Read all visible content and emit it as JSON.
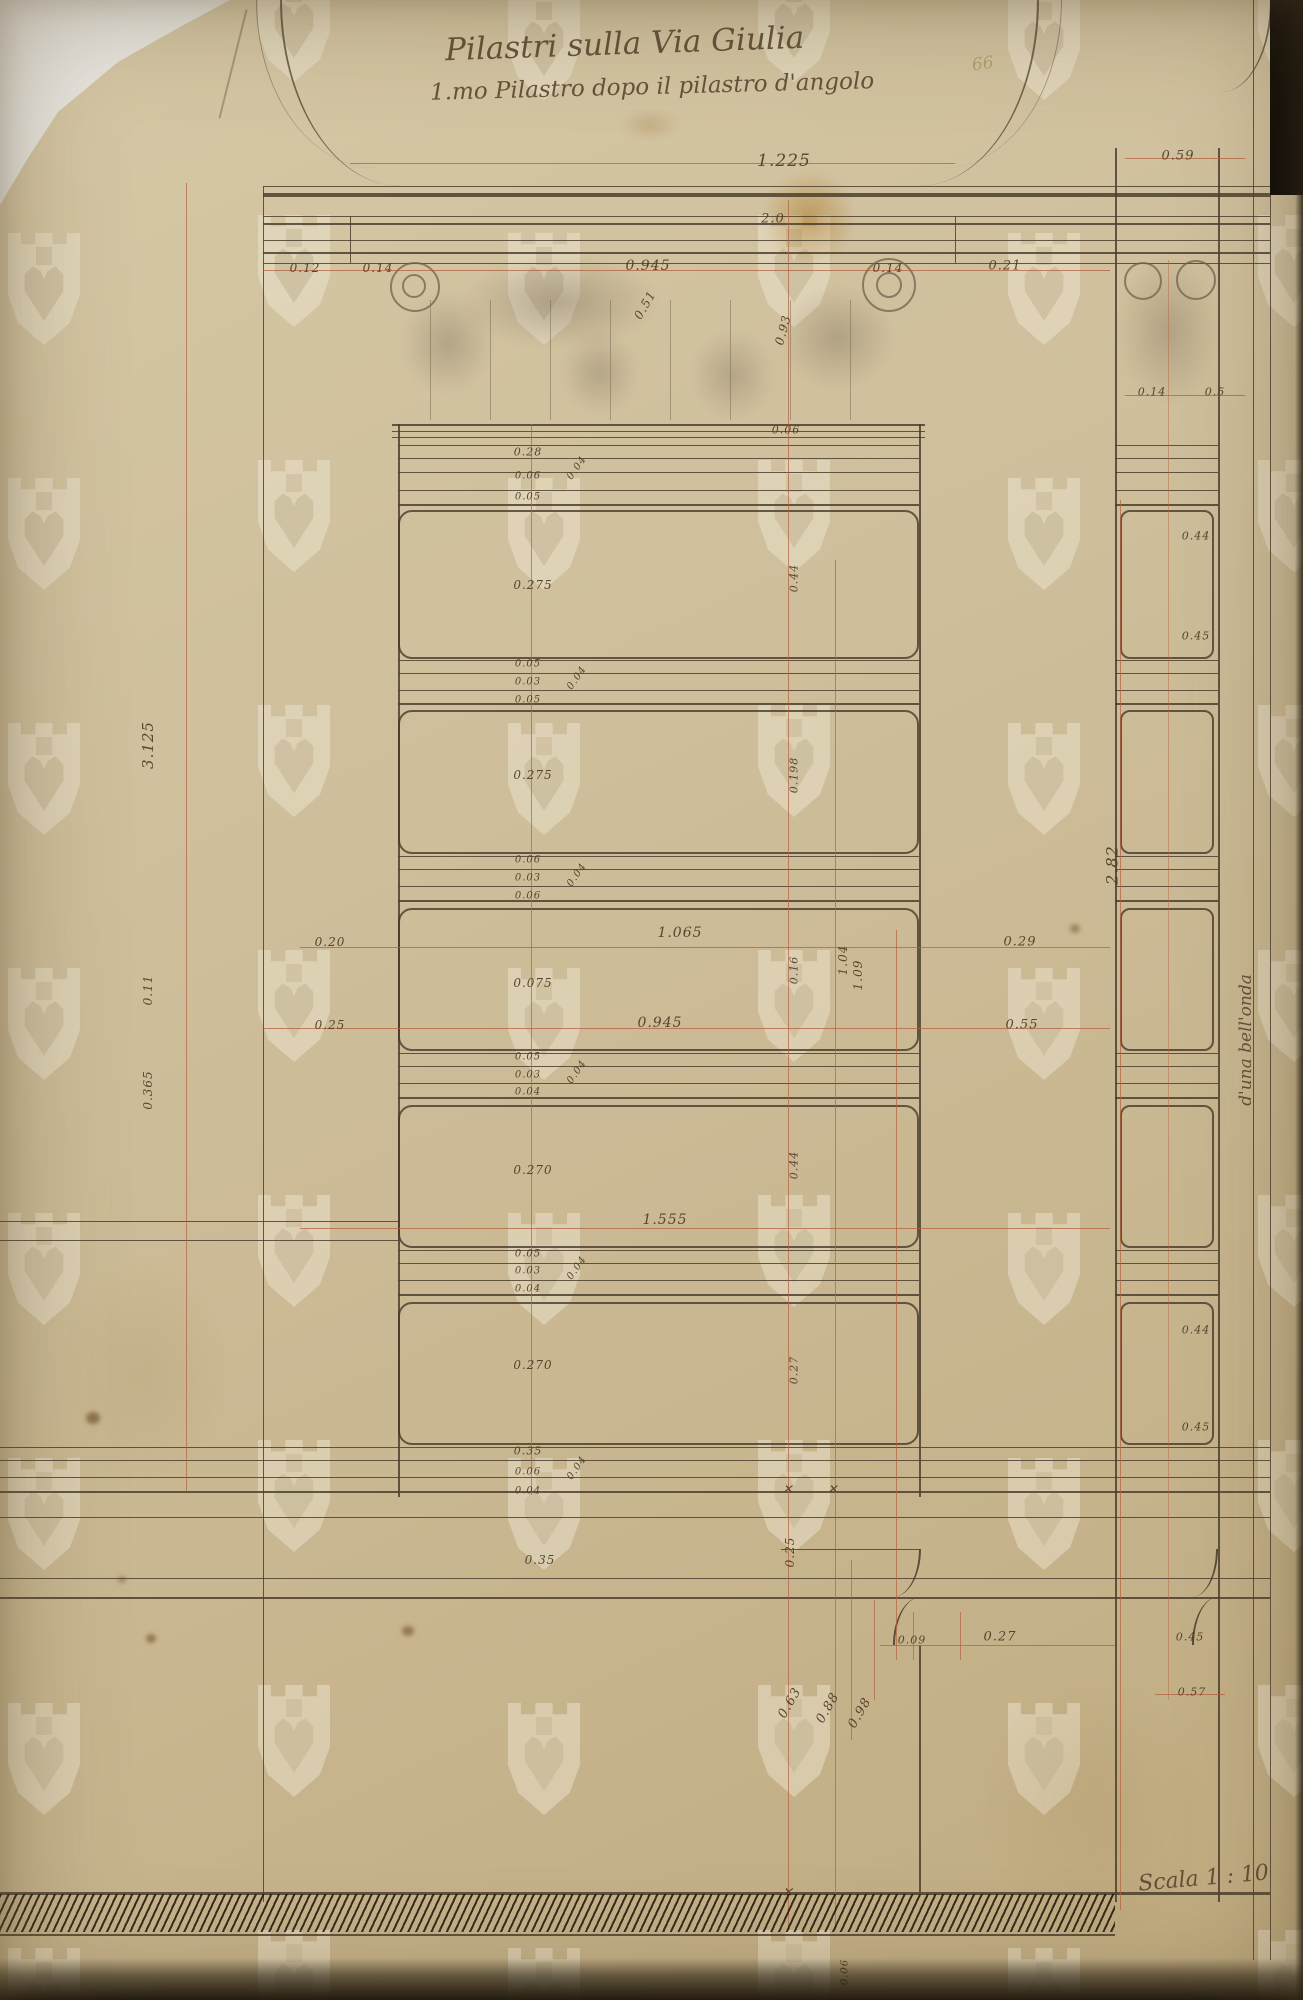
{
  "document": {
    "title_line1": "Pilastri sulla Via Giulia",
    "title_line2": "1.mo Pilastro dopo il pilastro d'angolo",
    "scale_label": "Scala 1 : 10",
    "side_note": "d'una bell'onda",
    "pencil_note": "66"
  },
  "colors": {
    "paper": "#cfbf9c",
    "sepia_ink": "#4c3f2f",
    "red_ink": "#b4623e",
    "pencil": "#776752",
    "backdrop": "#e9e7e1"
  },
  "dimension_labels": [
    {
      "text": "1.225",
      "x": 784,
      "y": 161,
      "size": 17
    },
    {
      "text": "0.59",
      "x": 1178,
      "y": 156,
      "size": 13
    },
    {
      "text": "2.0",
      "x": 773,
      "y": 219,
      "size": 13
    },
    {
      "text": "0.12",
      "x": 305,
      "y": 268,
      "size": 12
    },
    {
      "text": "0.14",
      "x": 378,
      "y": 268,
      "size": 12
    },
    {
      "text": "0.945",
      "x": 648,
      "y": 266,
      "size": 14
    },
    {
      "text": "0.14",
      "x": 888,
      "y": 268,
      "size": 12
    },
    {
      "text": "0.21",
      "x": 1005,
      "y": 266,
      "size": 13
    },
    {
      "text": "0.51",
      "x": 645,
      "y": 305,
      "rot": -60,
      "size": 12
    },
    {
      "text": "0.93",
      "x": 783,
      "y": 330,
      "rot": -75,
      "size": 12
    },
    {
      "text": "0.06",
      "x": 786,
      "y": 430,
      "size": 11
    },
    {
      "text": "0.28",
      "x": 528,
      "y": 452,
      "size": 11
    },
    {
      "text": "0.06",
      "x": 528,
      "y": 476,
      "size": 10
    },
    {
      "text": "0.05",
      "x": 528,
      "y": 497,
      "size": 10
    },
    {
      "text": "0.04",
      "x": 577,
      "y": 468,
      "rot": -55,
      "size": 10
    },
    {
      "text": "0.275",
      "x": 533,
      "y": 585,
      "size": 12
    },
    {
      "text": "0.05",
      "x": 528,
      "y": 664,
      "size": 10
    },
    {
      "text": "0.03",
      "x": 528,
      "y": 682,
      "size": 10
    },
    {
      "text": "0.05",
      "x": 528,
      "y": 700,
      "size": 10
    },
    {
      "text": "0.04",
      "x": 577,
      "y": 678,
      "rot": -55,
      "size": 10
    },
    {
      "text": "0.275",
      "x": 533,
      "y": 775,
      "size": 12
    },
    {
      "text": "0.06",
      "x": 528,
      "y": 860,
      "size": 10
    },
    {
      "text": "0.03",
      "x": 528,
      "y": 878,
      "size": 10
    },
    {
      "text": "0.06",
      "x": 528,
      "y": 896,
      "size": 10
    },
    {
      "text": "0.04",
      "x": 577,
      "y": 875,
      "rot": -55,
      "size": 10
    },
    {
      "text": "0.075",
      "x": 533,
      "y": 983,
      "size": 12
    },
    {
      "text": "0.05",
      "x": 528,
      "y": 1057,
      "size": 10
    },
    {
      "text": "0.03",
      "x": 528,
      "y": 1075,
      "size": 10
    },
    {
      "text": "0.04",
      "x": 528,
      "y": 1092,
      "size": 10
    },
    {
      "text": "0.04",
      "x": 577,
      "y": 1072,
      "rot": -55,
      "size": 10
    },
    {
      "text": "0.270",
      "x": 533,
      "y": 1170,
      "size": 12
    },
    {
      "text": "0.05",
      "x": 528,
      "y": 1254,
      "size": 10
    },
    {
      "text": "0.03",
      "x": 528,
      "y": 1271,
      "size": 10
    },
    {
      "text": "0.04",
      "x": 528,
      "y": 1289,
      "size": 10
    },
    {
      "text": "0.04",
      "x": 577,
      "y": 1268,
      "rot": -55,
      "size": 10
    },
    {
      "text": "0.270",
      "x": 533,
      "y": 1365,
      "size": 12
    },
    {
      "text": "0.35",
      "x": 528,
      "y": 1451,
      "size": 11
    },
    {
      "text": "0.06",
      "x": 528,
      "y": 1472,
      "size": 10
    },
    {
      "text": "0.04",
      "x": 528,
      "y": 1491,
      "size": 10
    },
    {
      "text": "0.04",
      "x": 577,
      "y": 1468,
      "rot": -55,
      "size": 10
    },
    {
      "text": "0.44",
      "x": 794,
      "y": 578,
      "rot": -90,
      "size": 11
    },
    {
      "text": "0.198",
      "x": 794,
      "y": 775,
      "rot": -90,
      "size": 11
    },
    {
      "text": "0.16",
      "x": 794,
      "y": 970,
      "rot": -90,
      "size": 11
    },
    {
      "text": "0.44",
      "x": 794,
      "y": 1165,
      "rot": -90,
      "size": 11
    },
    {
      "text": "0.27",
      "x": 794,
      "y": 1370,
      "rot": -90,
      "size": 11
    },
    {
      "text": "1.04",
      "x": 843,
      "y": 960,
      "rot": -90,
      "size": 12
    },
    {
      "text": "1.09",
      "x": 858,
      "y": 975,
      "rot": -90,
      "size": 12
    },
    {
      "text": "0.20",
      "x": 330,
      "y": 942,
      "size": 12
    },
    {
      "text": "1.065",
      "x": 680,
      "y": 933,
      "size": 14
    },
    {
      "text": "0.29",
      "x": 1020,
      "y": 942,
      "size": 13
    },
    {
      "text": "0.25",
      "x": 330,
      "y": 1025,
      "size": 12
    },
    {
      "text": "0.945",
      "x": 660,
      "y": 1023,
      "size": 14
    },
    {
      "text": "0.55",
      "x": 1022,
      "y": 1025,
      "size": 13
    },
    {
      "text": "1.555",
      "x": 665,
      "y": 1220,
      "size": 14
    },
    {
      "text": "3.125",
      "x": 148,
      "y": 745,
      "rot": -90,
      "size": 15
    },
    {
      "text": "0.11",
      "x": 148,
      "y": 990,
      "rot": -90,
      "size": 12
    },
    {
      "text": "0.365",
      "x": 148,
      "y": 1090,
      "rot": -90,
      "size": 12
    },
    {
      "text": "2.82",
      "x": 1112,
      "y": 865,
      "rot": -90,
      "size": 16
    },
    {
      "text": "0.14",
      "x": 1152,
      "y": 392,
      "size": 11
    },
    {
      "text": "0.5",
      "x": 1215,
      "y": 392,
      "size": 11
    },
    {
      "text": "0.44",
      "x": 1196,
      "y": 536,
      "size": 11
    },
    {
      "text": "0.45",
      "x": 1196,
      "y": 636,
      "size": 11
    },
    {
      "text": "0.44",
      "x": 1196,
      "y": 1330,
      "size": 11
    },
    {
      "text": "0.45",
      "x": 1196,
      "y": 1427,
      "size": 11
    },
    {
      "text": "0.45",
      "x": 1190,
      "y": 1637,
      "size": 11
    },
    {
      "text": "0.57",
      "x": 1192,
      "y": 1692,
      "size": 11
    },
    {
      "text": "0.25",
      "x": 790,
      "y": 1552,
      "rot": -90,
      "size": 12
    },
    {
      "text": "0.35",
      "x": 540,
      "y": 1560,
      "size": 12
    },
    {
      "text": "0.09",
      "x": 912,
      "y": 1640,
      "size": 11
    },
    {
      "text": "0.27",
      "x": 1000,
      "y": 1637,
      "size": 13
    },
    {
      "text": "0.63",
      "x": 790,
      "y": 1703,
      "rot": -60,
      "size": 13
    },
    {
      "text": "0.88",
      "x": 828,
      "y": 1708,
      "rot": -60,
      "size": 13
    },
    {
      "text": "0.98",
      "x": 860,
      "y": 1713,
      "rot": -60,
      "size": 13
    },
    {
      "text": "0.06",
      "x": 845,
      "y": 1972,
      "rot": -90,
      "size": 10
    },
    {
      "text": "✕",
      "x": 788,
      "y": 1489,
      "size": 12
    },
    {
      "text": "✕",
      "x": 833,
      "y": 1489,
      "size": 12
    },
    {
      "text": "✕",
      "x": 788,
      "y": 1893,
      "size": 13
    }
  ]
}
